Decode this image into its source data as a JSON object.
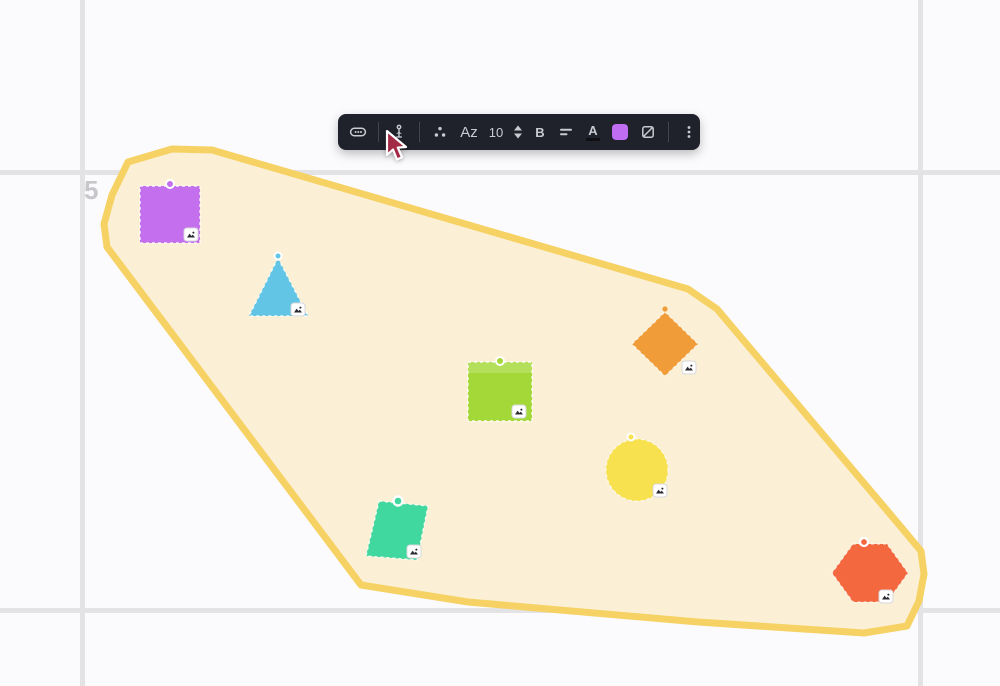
{
  "canvas": {
    "background": "#fbfbfd",
    "grid_color": "#e3e3e6",
    "coordinate_label": "5",
    "coordinate_label_color": "#c6c6cb"
  },
  "highlight_region": {
    "fill": "#fbf0d6",
    "stroke": "#f6d265"
  },
  "shapes": [
    {
      "id": "purple-square",
      "type": "square",
      "color": "#c46fee"
    },
    {
      "id": "blue-triangle",
      "type": "triangle",
      "color": "#63c5e5"
    },
    {
      "id": "green-square",
      "type": "square",
      "color": "#a3d838"
    },
    {
      "id": "orange-diamond",
      "type": "diamond",
      "color": "#f09c38"
    },
    {
      "id": "yellow-circle",
      "type": "circle",
      "color": "#f8e14e"
    },
    {
      "id": "teal-parallelogram",
      "type": "parallelogram",
      "color": "#41d89f"
    },
    {
      "id": "red-hexagon",
      "type": "hexagon",
      "color": "#f4683f"
    }
  ],
  "badge": {
    "background": "#ffffff",
    "glyph_color": "#2a2a33",
    "icon": "image-badge-icon"
  },
  "toolbar": {
    "background": "#1f212b",
    "icon_color": "#c9cbd3",
    "font_family_label": "Az",
    "font_size_value": "10",
    "bold_label": "B",
    "text_color_label": "A",
    "text_color_current": "#101014",
    "fill_color_current": "#c06df2"
  },
  "cursor": {
    "color": "#a32a45"
  }
}
